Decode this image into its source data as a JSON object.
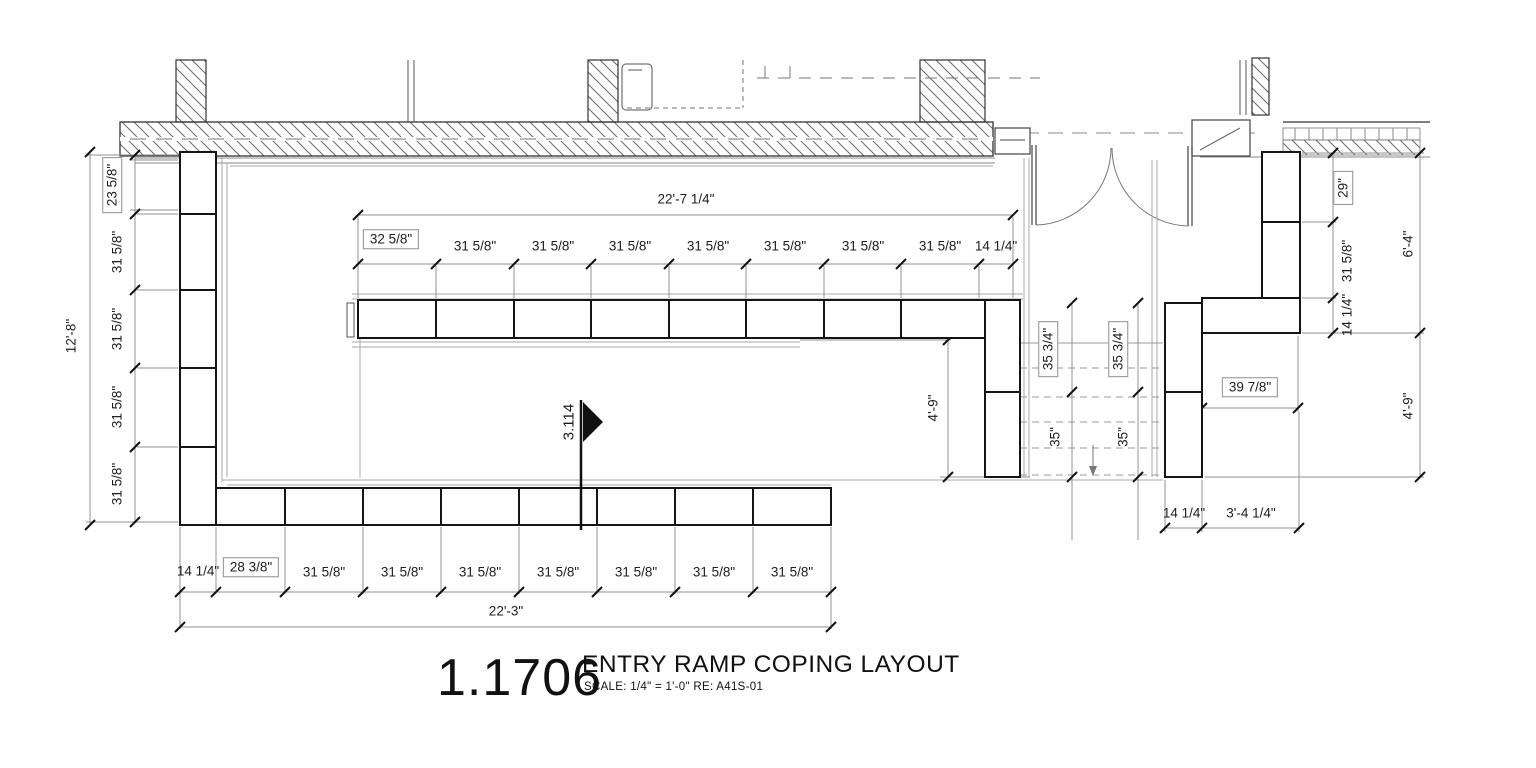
{
  "drawing": {
    "number": "1.1706",
    "title": "ENTRY RAMP COPING LAYOUT",
    "scale_note": "SCALE:   1/4\" = 1'-0\"   RE: A41S-01"
  },
  "marker": {
    "label": "3.114"
  },
  "dimensions": {
    "top": {
      "overall": "22'-7 1/4\"",
      "segments": [
        "32 5/8\"",
        "31 5/8\"",
        "31 5/8\"",
        "31 5/8\"",
        "31 5/8\"",
        "31 5/8\"",
        "31 5/8\"",
        "31 5/8\"",
        "14 1/4\""
      ]
    },
    "left": {
      "overall": "12'-8\"",
      "segments": [
        "23 5/8\"",
        "31 5/8\"",
        "31 5/8\"",
        "31 5/8\"",
        "31 5/8\""
      ]
    },
    "bottom": {
      "overall": "22'-3\"",
      "segments": [
        "14 1/4\"",
        "28 3/8\"",
        "31 5/8\"",
        "31 5/8\"",
        "31 5/8\"",
        "31 5/8\"",
        "31 5/8\"",
        "31 5/8\"",
        "31 5/8\""
      ]
    },
    "right_inner": {
      "segments": [
        "29\"",
        "31 5/8\"",
        "14 1/4\""
      ]
    },
    "right_outer": {
      "segments": [
        "6'-4\"",
        "4'-9\""
      ]
    },
    "stair_left_height": "4'-9\"",
    "stair_run_left": {
      "upper": "35 3/4\"",
      "lower": "35\""
    },
    "stair_run_right": {
      "upper": "35 3/4\"",
      "lower": "35\""
    },
    "step_return": "39 7/8\"",
    "bottom_right": {
      "segments": [
        "14 1/4\"",
        "3'-4 1/4\""
      ]
    }
  }
}
